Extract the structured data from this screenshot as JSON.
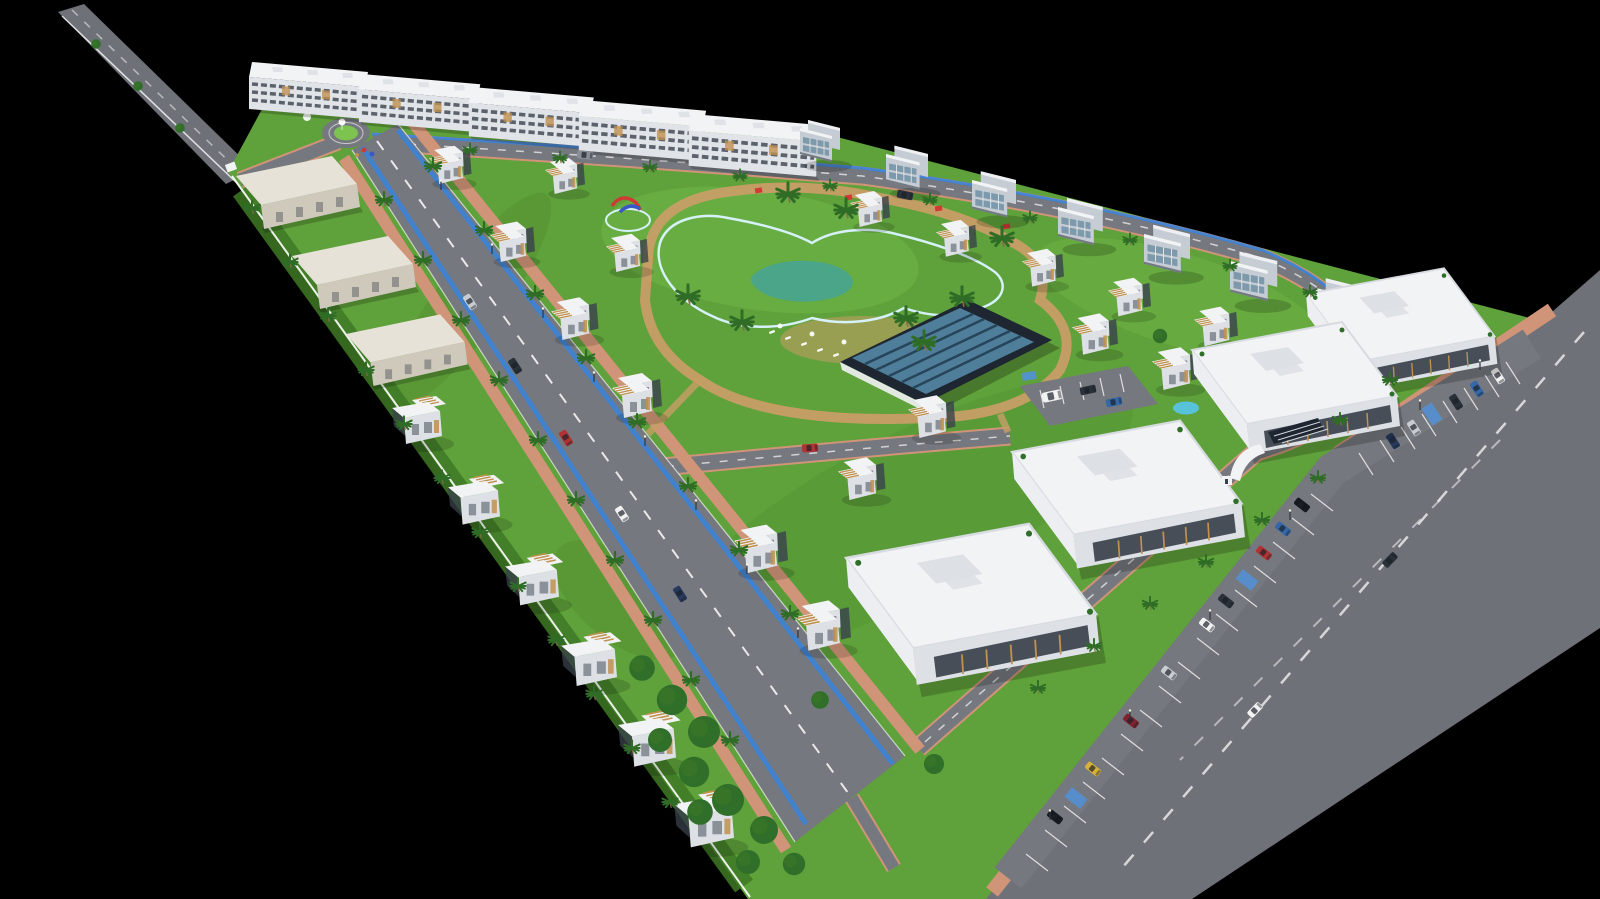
{
  "meta": {
    "description": "Aerial 3D architectural rendering of a triangular gated resort community master plan on a black background: perimeter apartment rows, twin-villa rows along a tree-lined boulevard, central free-form swimming pool with water slides and a glass-roof clubhouse, commercial strip with storefront buildings and angled parking along an external highway.",
    "image_width": 1600,
    "image_height": 899
  },
  "colors": {
    "background": "#000000",
    "grass": "#5fa13a",
    "grass_dark": "#3f7a25",
    "grass_light": "#7cc34f",
    "road": "#75787e",
    "highway": "#6e7177",
    "sidewalk": "#d09478",
    "lane_mark": "#e9e9e9",
    "white": "#ffffff",
    "bike_lane": "#3c83d8",
    "building_white": "#f2f3f5",
    "building_face": "#dde1e6",
    "building_side": "#eceef1",
    "window_dark": "#3a414c",
    "slab_roof": "#e6e2d8",
    "slab_face": "#cfc9bc",
    "apt_face": "#e0e4e8",
    "gray_villa": "#c6ccd3",
    "glass_blue": "#7d99ac",
    "pergola_wood": "#c0914f",
    "pool_water": "#58c7ea",
    "pool_deep": "#2d9ed2",
    "pool_rim": "#d6f1fa",
    "path_sand": "#c79e66",
    "clubhouse_frame": "#1e2731",
    "clubhouse_glass": "#4f7e9a",
    "clubhouse_glass_dark": "#27455a",
    "palm_green": "#2f6d26",
    "palm_trunk": "#8a6b4a",
    "tree_green": "#2f6f2a",
    "slide_red": "#cf3a34",
    "slide_blue": "#3a57c9",
    "handicap_blue": "#5291d8",
    "car_white": "#f2f2f2",
    "car_red": "#b03232",
    "car_dark": "#2b3138",
    "car_gray": "#8b9097",
    "car_blue": "#3468a8",
    "car_yellow": "#d8b13a",
    "car_maroon": "#7e2430",
    "car_navy": "#273a5e",
    "car_silver": "#c9ccd1",
    "car_black": "#15181d"
  },
  "scene": {
    "site_shape": "right-triangle wedge, black void around",
    "counts": {
      "top_apartment_blocks": 5,
      "gray_townhouse_blocks": 8,
      "left_slab_buildings": 3,
      "detached_villas": 24,
      "commercial_buildings": 4,
      "clubhouse": 1,
      "main_pool": 1,
      "kids_pool": 1,
      "splash_pad": 1,
      "roundabout": 1,
      "entrance_gate": 1,
      "palm_trees": 56,
      "trees_and_bushes": 16,
      "parked_cars": 17,
      "moving_cars": 10,
      "sun_loungers": 10,
      "street_lights": 14
    }
  }
}
